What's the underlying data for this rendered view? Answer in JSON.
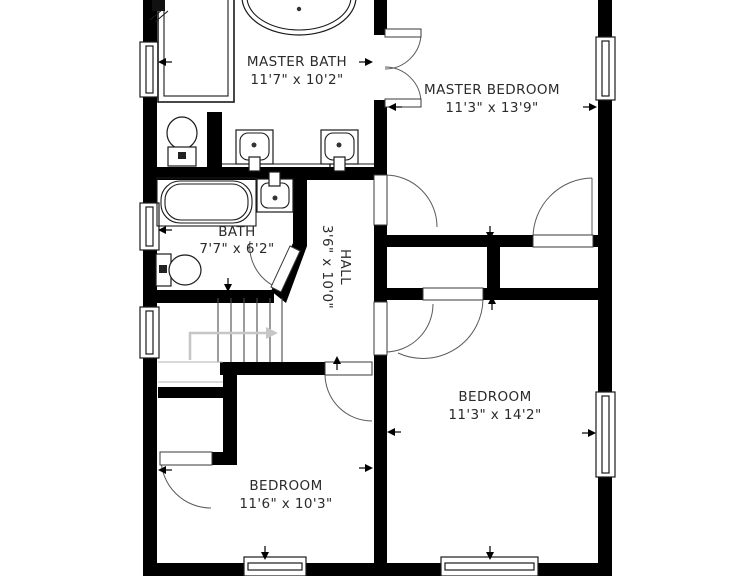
{
  "plan": {
    "type": "residential-floor-plan",
    "rooms": [
      {
        "name": "MASTER BATH",
        "dims": "11'7\" x 10'2\""
      },
      {
        "name": "MASTER BEDROOM",
        "dims": "11'3\" x 13'9\""
      },
      {
        "name": "BATH",
        "dims": "7'7\" x 6'2\""
      },
      {
        "name": "HALL",
        "dims": "3'6\" x 10'0\""
      },
      {
        "name": "BEDROOM",
        "dims": "11'3\" x 14'2\""
      },
      {
        "name": "BEDROOM",
        "dims": "11'6\" x 10'3\""
      }
    ],
    "fixtures": {
      "master_bath": [
        "shower",
        "freestanding-tub",
        "toilet",
        "double-vanity-sinks"
      ],
      "bath": [
        "bathtub",
        "sink",
        "toilet"
      ],
      "staircase": {
        "treads": 6,
        "direction_arrow": "right"
      }
    },
    "windows": {
      "left_wall": 3,
      "right_wall": 2,
      "bottom_wall": 2
    },
    "doors": [
      "french-doors-master-bath",
      "door-master-bedroom",
      "closet-door-master-bedroom",
      "door-bath-diagonal",
      "door-bedroom-right",
      "closet-door-bedroom-right",
      "door-bedroom-left",
      "closet-door-bedroom-left"
    ],
    "colors": {
      "wall": "#000000",
      "floor": "#ffffff",
      "label_text": "#2b2b2b",
      "stair_arrow": "#c6c6c6"
    }
  }
}
